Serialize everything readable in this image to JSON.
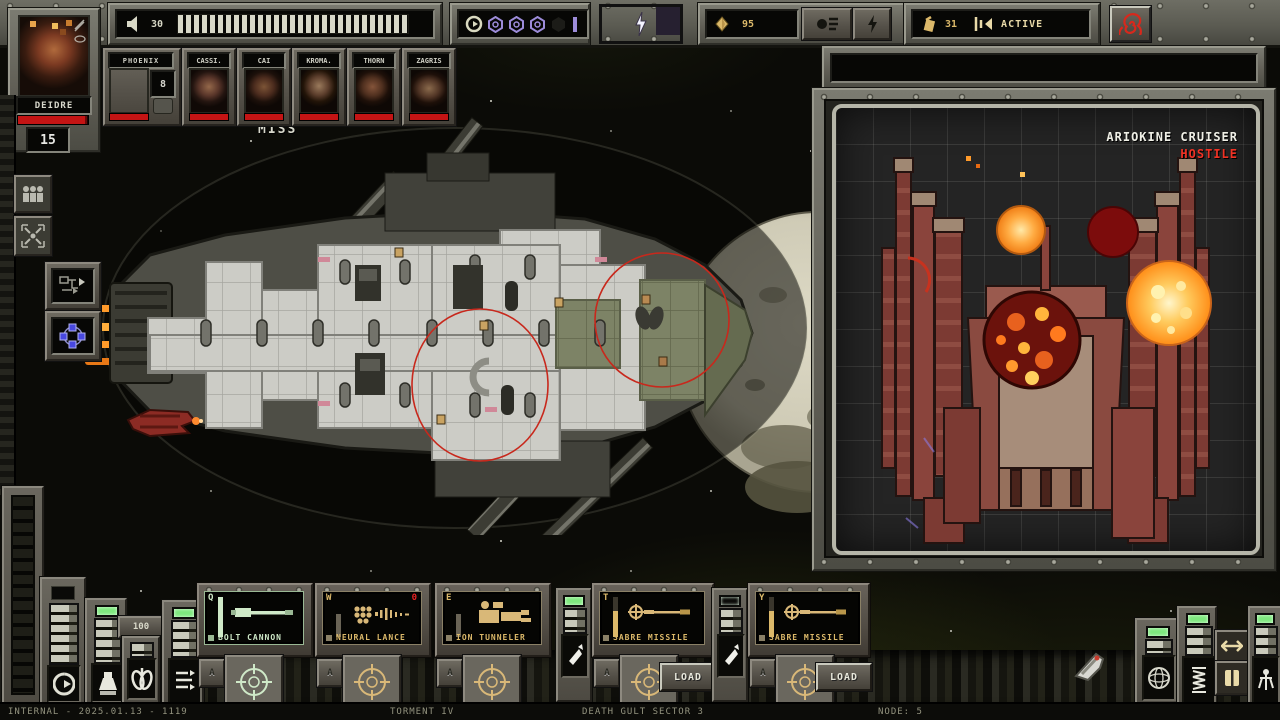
{
  "colors": {
    "health": "#c41414",
    "hostile": "#f03224",
    "gold": "#dcb96a",
    "cream": "#e9daa8",
    "screen_green": "#cfe9c8",
    "purple": "#9d8cda",
    "pale": "#d8d8c6",
    "red_accent": "#c8281c",
    "lamp_green": "#7de87d"
  },
  "top_bar": {
    "audio": {
      "icon": "speaker-icon",
      "value": "30"
    },
    "power_cells": 30,
    "scrap": {
      "icon": "diamond-icon",
      "value": "95"
    },
    "fuel": {
      "icon": "fuel-icon",
      "value": "31"
    },
    "alert": {
      "label": "ACTIVE"
    }
  },
  "captain": {
    "name": "DEIDRE",
    "hull": "15"
  },
  "crew": [
    {
      "name": "PHOENIX",
      "badge": "8"
    },
    {
      "name": "CASSI."
    },
    {
      "name": "CAI"
    },
    {
      "name": "KROMA."
    },
    {
      "name": "THORN"
    },
    {
      "name": "ZAGRIS"
    }
  ],
  "battle": {
    "float_text": "MISS"
  },
  "enemy": {
    "name": "ARIOKINE CRUISER",
    "status": "HOSTILE"
  },
  "systems": {
    "gauge_value": "100"
  },
  "weapons": [
    {
      "key": "Q",
      "name": "BOLT CANNON",
      "auto": "A"
    },
    {
      "key": "W",
      "name": "NEURAL LANCE",
      "auto": "A",
      "count": "0"
    },
    {
      "key": "E",
      "name": "ION TUNNELER",
      "auto": "A"
    },
    {
      "key": "T",
      "name": "SABRE MISSILE",
      "auto": "A",
      "load": "LOAD"
    },
    {
      "key": "Y",
      "name": "SABRE MISSILE",
      "auto": "A",
      "load": "LOAD"
    }
  ],
  "status_bar": {
    "build": "INTERNAL - 2025.01.13 - 1119",
    "difficulty": "TORMENT IV",
    "sector": "DEATH GULT SECTOR 3",
    "node": "NODE: 5"
  }
}
